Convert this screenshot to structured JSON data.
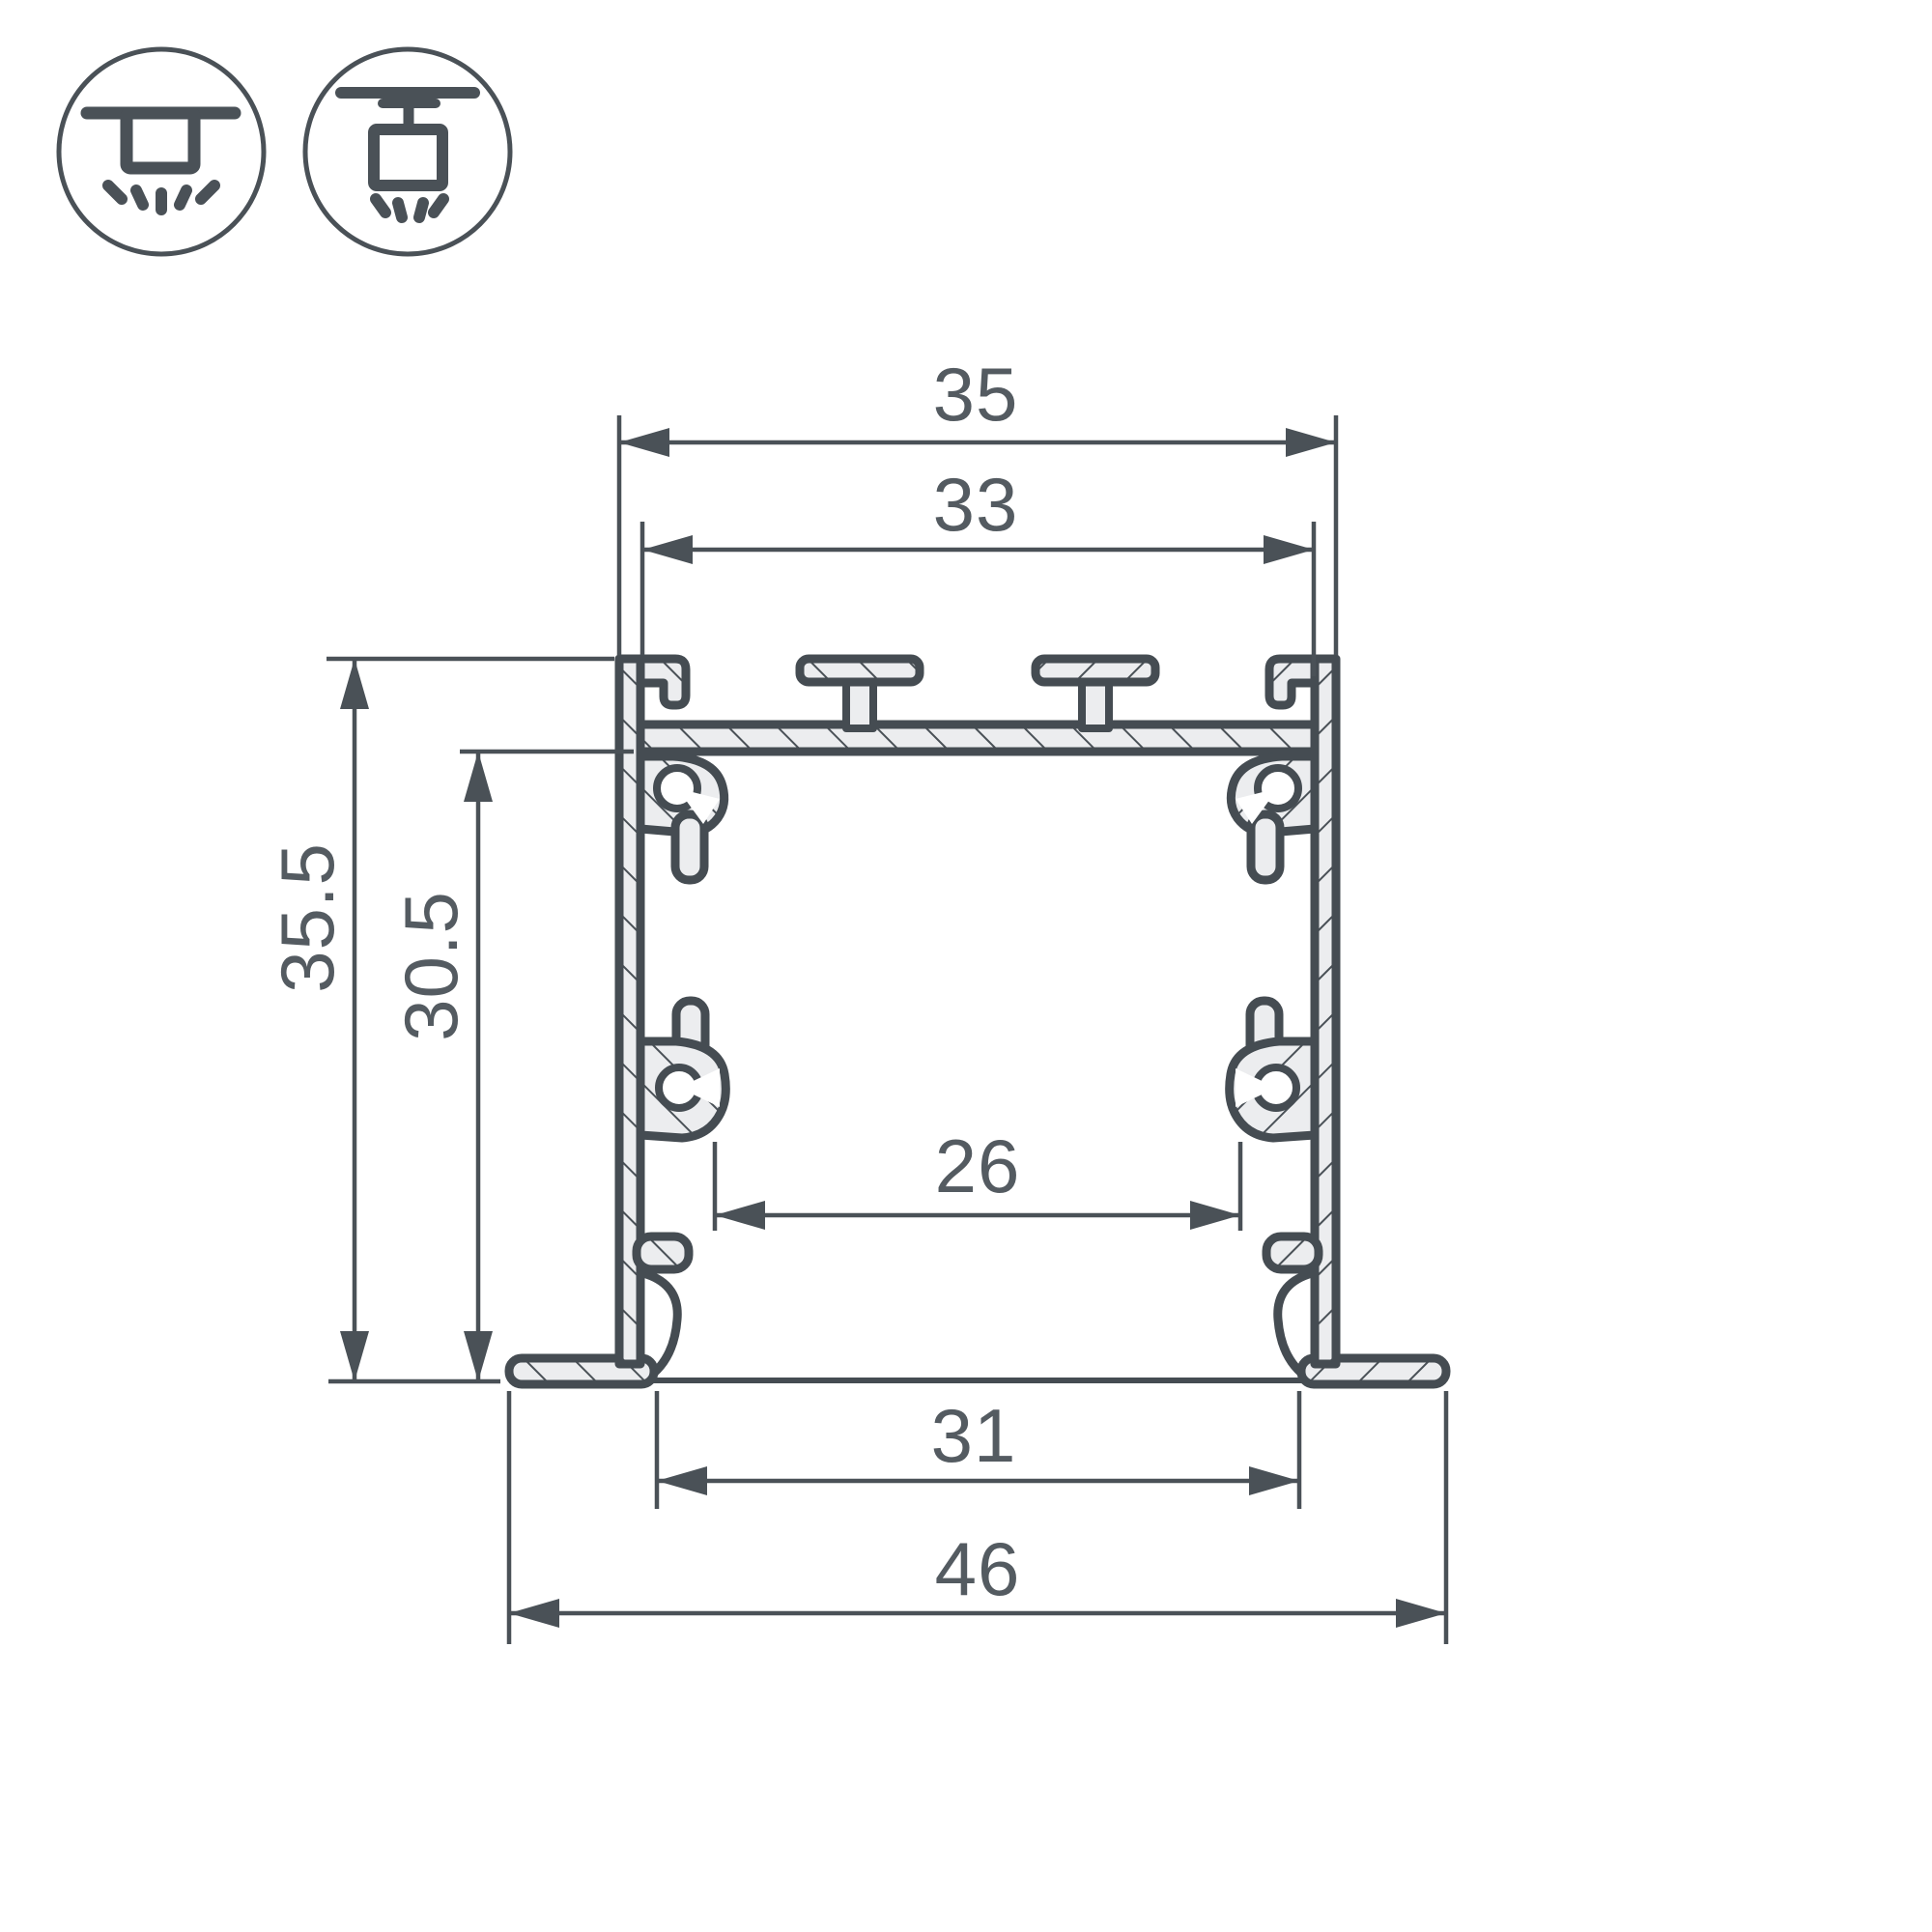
{
  "drawing": {
    "type": "led-profile-cross-section",
    "colors": {
      "background": "#ffffff",
      "line": "#4a5157",
      "profile_fill": "#ecedef",
      "text": "#545b61"
    },
    "icons": [
      {
        "name": "recessed-mount-icon"
      },
      {
        "name": "surface-mount-icon"
      }
    ],
    "dimensions": {
      "outer_width": {
        "label": "35"
      },
      "inner_top_width": {
        "label": "33"
      },
      "total_height": {
        "label": "35.5"
      },
      "inner_height": {
        "label": "30.5"
      },
      "inner_width": {
        "label": "26"
      },
      "cutout_width": {
        "label": "31"
      },
      "flange_width": {
        "label": "46"
      }
    }
  }
}
